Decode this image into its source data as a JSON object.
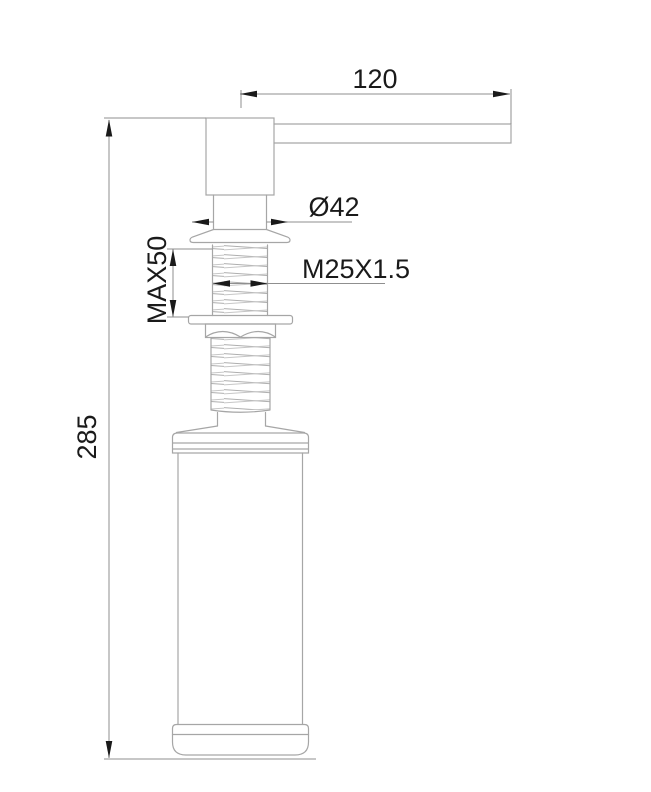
{
  "drawing": {
    "labels": {
      "spout_reach": "120",
      "flange_diameter": "Ø42",
      "max_mounting": "MAX50",
      "thread_spec": "M25X1.5",
      "total_height": "285"
    },
    "colors": {
      "background": "#ffffff",
      "part_line": "#a6a6a6",
      "dimension_line": "#8f8f8f",
      "annotation": "#1a1a1a"
    }
  }
}
